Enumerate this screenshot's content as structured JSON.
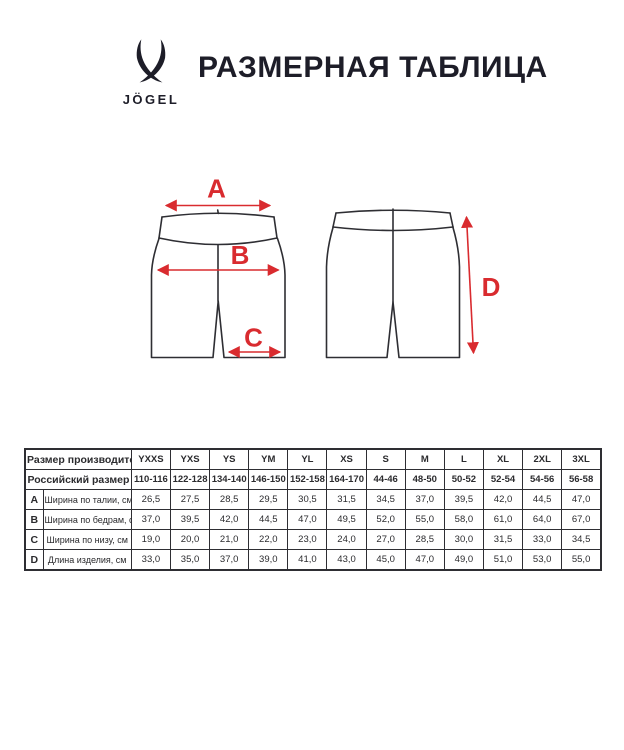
{
  "brand": {
    "wordmark": "JÖGEL"
  },
  "header": {
    "title": "РАЗМЕРНАЯ ТАБЛИЦА"
  },
  "colors": {
    "accent_red": "#d92b2f",
    "outline": "#2e2e33",
    "table_ink": "#2b2b2e",
    "title_ink": "#1d1d28",
    "background": "#ffffff"
  },
  "diagram": {
    "labels": {
      "a": "A",
      "b": "B",
      "c": "C",
      "d": "D"
    }
  },
  "table": {
    "manufacturer_row": {
      "label": "Размер производителя",
      "sizes": [
        "YXXS",
        "YXS",
        "YS",
        "YM",
        "YL",
        "XS",
        "S",
        "M",
        "L",
        "XL",
        "2XL",
        "3XL"
      ]
    },
    "russian_row": {
      "label": "Российский размер",
      "values": [
        "110-116",
        "122-128",
        "134-140",
        "146-150",
        "152-158",
        "164-170",
        "44-46",
        "48-50",
        "50-52",
        "52-54",
        "54-56",
        "56-58"
      ]
    },
    "measurement_rows": [
      {
        "letter": "A",
        "label": "Ширина по талии, см",
        "values": [
          "26,5",
          "27,5",
          "28,5",
          "29,5",
          "30,5",
          "31,5",
          "34,5",
          "37,0",
          "39,5",
          "42,0",
          "44,5",
          "47,0"
        ]
      },
      {
        "letter": "B",
        "label": "Ширина по бедрам, см",
        "values": [
          "37,0",
          "39,5",
          "42,0",
          "44,5",
          "47,0",
          "49,5",
          "52,0",
          "55,0",
          "58,0",
          "61,0",
          "64,0",
          "67,0"
        ]
      },
      {
        "letter": "C",
        "label": "Ширина по низу, см",
        "values": [
          "19,0",
          "20,0",
          "21,0",
          "22,0",
          "23,0",
          "24,0",
          "27,0",
          "28,5",
          "30,0",
          "31,5",
          "33,0",
          "34,5"
        ]
      },
      {
        "letter": "D",
        "label": "Длина изделия, см",
        "values": [
          "33,0",
          "35,0",
          "37,0",
          "39,0",
          "41,0",
          "43,0",
          "45,0",
          "47,0",
          "49,0",
          "51,0",
          "53,0",
          "55,0"
        ]
      }
    ]
  }
}
